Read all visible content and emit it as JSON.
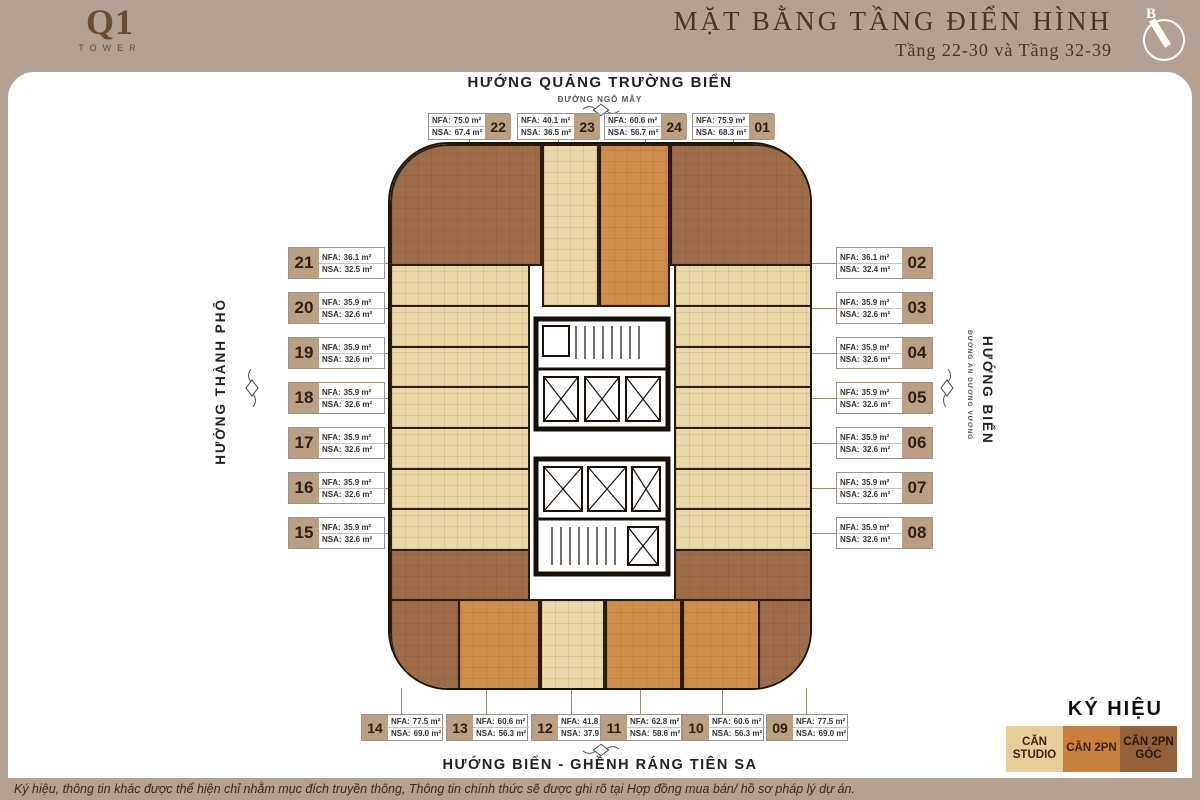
{
  "header": {
    "logo_main": "Q1",
    "logo_sub": "TOWER",
    "title": "MẶT BẰNG TẦNG ĐIỂN HÌNH",
    "subtitle": "Tầng 22-30 và Tầng 32-39",
    "compass_label": "B"
  },
  "directions": {
    "top_main": "HƯỚNG QUẢNG TRƯỜNG BIỂN",
    "top_street": "ĐƯỜNG NGÔ MÂY",
    "left_main": "HƯỚNG THÀNH PHỐ",
    "right_main": "HƯỚNG BIỂN",
    "right_street": "ĐƯỜNG AN DƯƠNG VƯƠNG",
    "bottom_main": "HƯỚNG BIỂN - GHỀNH RÁNG TIÊN SA"
  },
  "labels": {
    "nfa": "NFA:",
    "nsa": "NSA:"
  },
  "legend": {
    "title": "KÝ HIỆU",
    "items": [
      {
        "label": "CĂN STUDIO",
        "color": "#e8cd9b"
      },
      {
        "label": "CĂN 2PN",
        "color": "#c8803f"
      },
      {
        "label": "CĂN 2PN GÓC",
        "color": "#93613a"
      }
    ]
  },
  "footer": {
    "disclaimer": "Ký hiệu, thông tin khác được thể hiện chỉ nhằm mục đích truyền thông, Thông tin chính thức sẽ được ghi rõ tại Hợp đồng mua bán/ hồ sơ pháp lý dự án."
  },
  "units": {
    "u01": {
      "num": "01",
      "nfa": "75.9 m²",
      "nsa": "68.3 m²",
      "type": "2PN GÓC"
    },
    "u02": {
      "num": "02",
      "nfa": "36.1 m²",
      "nsa": "32.4 m²",
      "type": "STUDIO"
    },
    "u03": {
      "num": "03",
      "nfa": "35.9 m²",
      "nsa": "32.6 m²",
      "type": "STUDIO"
    },
    "u04": {
      "num": "04",
      "nfa": "35.9 m²",
      "nsa": "32.6 m²",
      "type": "STUDIO"
    },
    "u05": {
      "num": "05",
      "nfa": "35.9 m²",
      "nsa": "32.6 m²",
      "type": "STUDIO"
    },
    "u06": {
      "num": "06",
      "nfa": "35.9 m²",
      "nsa": "32.6 m²",
      "type": "STUDIO"
    },
    "u07": {
      "num": "07",
      "nfa": "35.9 m²",
      "nsa": "32.6 m²",
      "type": "STUDIO"
    },
    "u08": {
      "num": "08",
      "nfa": "35.9 m²",
      "nsa": "32.6 m²",
      "type": "STUDIO"
    },
    "u09": {
      "num": "09",
      "nfa": "77.5 m²",
      "nsa": "69.0 m²",
      "type": "2PN GÓC"
    },
    "u10": {
      "num": "10",
      "nfa": "60.6 m²",
      "nsa": "56.3 m²",
      "type": "2PN"
    },
    "u11": {
      "num": "11",
      "nfa": "62.8 m²",
      "nsa": "58.6 m²",
      "type": "2PN"
    },
    "u12": {
      "num": "12",
      "nfa": "41.8 m²",
      "nsa": "37.9 m²",
      "type": "STUDIO"
    },
    "u13": {
      "num": "13",
      "nfa": "60.6 m²",
      "nsa": "56.3 m²",
      "type": "2PN"
    },
    "u14": {
      "num": "14",
      "nfa": "77.5 m²",
      "nsa": "69.0 m²",
      "type": "2PN GÓC"
    },
    "u15": {
      "num": "15",
      "nfa": "35.9 m²",
      "nsa": "32.6 m²",
      "type": "STUDIO"
    },
    "u16": {
      "num": "16",
      "nfa": "35.9 m²",
      "nsa": "32.6 m²",
      "type": "STUDIO"
    },
    "u17": {
      "num": "17",
      "nfa": "35.9 m²",
      "nsa": "32.6 m²",
      "type": "STUDIO"
    },
    "u18": {
      "num": "18",
      "nfa": "35.9 m²",
      "nsa": "32.6 m²",
      "type": "STUDIO"
    },
    "u19": {
      "num": "19",
      "nfa": "35.9 m²",
      "nsa": "32.6 m²",
      "type": "STUDIO"
    },
    "u20": {
      "num": "20",
      "nfa": "35.9 m²",
      "nsa": "32.6 m²",
      "type": "STUDIO"
    },
    "u21": {
      "num": "21",
      "nfa": "36.1 m²",
      "nsa": "32.5 m²",
      "type": "STUDIO"
    },
    "u22": {
      "num": "22",
      "nfa": "75.0 m²",
      "nsa": "67.4 m²",
      "type": "2PN GÓC"
    },
    "u23": {
      "num": "23",
      "nfa": "40.1 m²",
      "nsa": "36.5 m²",
      "type": "STUDIO"
    },
    "u24": {
      "num": "24",
      "nfa": "60.6 m²",
      "nsa": "56.7 m²",
      "type": "2PN"
    }
  }
}
